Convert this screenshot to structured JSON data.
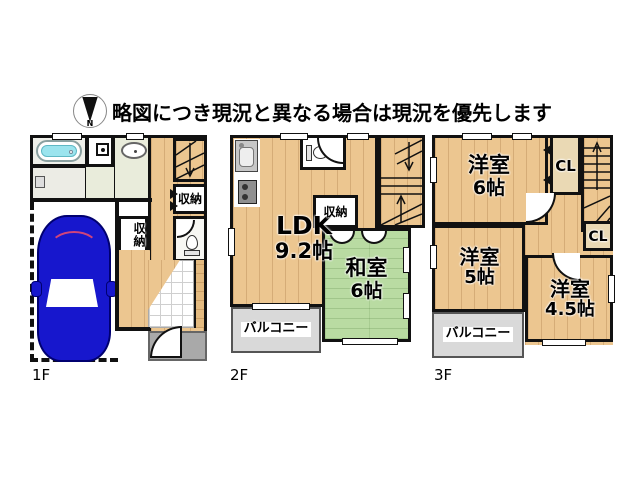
{
  "header": {
    "compass_label": "N",
    "disclaimer": "略図につき現況と異なる場合は現況を優先します"
  },
  "colors": {
    "wall": "#111111",
    "wood": "#ecc690",
    "tatami": "#b9dba2",
    "balcony": "#d9d9d9",
    "porch": "#a9a9a9",
    "tub": "#9be4ee",
    "car": "#1717cd"
  },
  "floors": {
    "f1": {
      "label": "1F",
      "hall_closet": "収納",
      "side_closet": "収納"
    },
    "f2": {
      "label": "2F",
      "ldk_name": "LDK",
      "ldk_size": "9.2帖",
      "washitsu_name": "和室",
      "washitsu_size": "6帖",
      "closet": "収納",
      "balcony": "バルコニー"
    },
    "f3": {
      "label": "3F",
      "room6_name": "洋室",
      "room6_size": "6帖",
      "closet_top": "CL",
      "room5_name": "洋室",
      "room5_size": "5帖",
      "room45_name": "洋室",
      "room45_size": "4.5帖",
      "closet_bottom": "CL",
      "balcony": "バルコニー"
    }
  }
}
